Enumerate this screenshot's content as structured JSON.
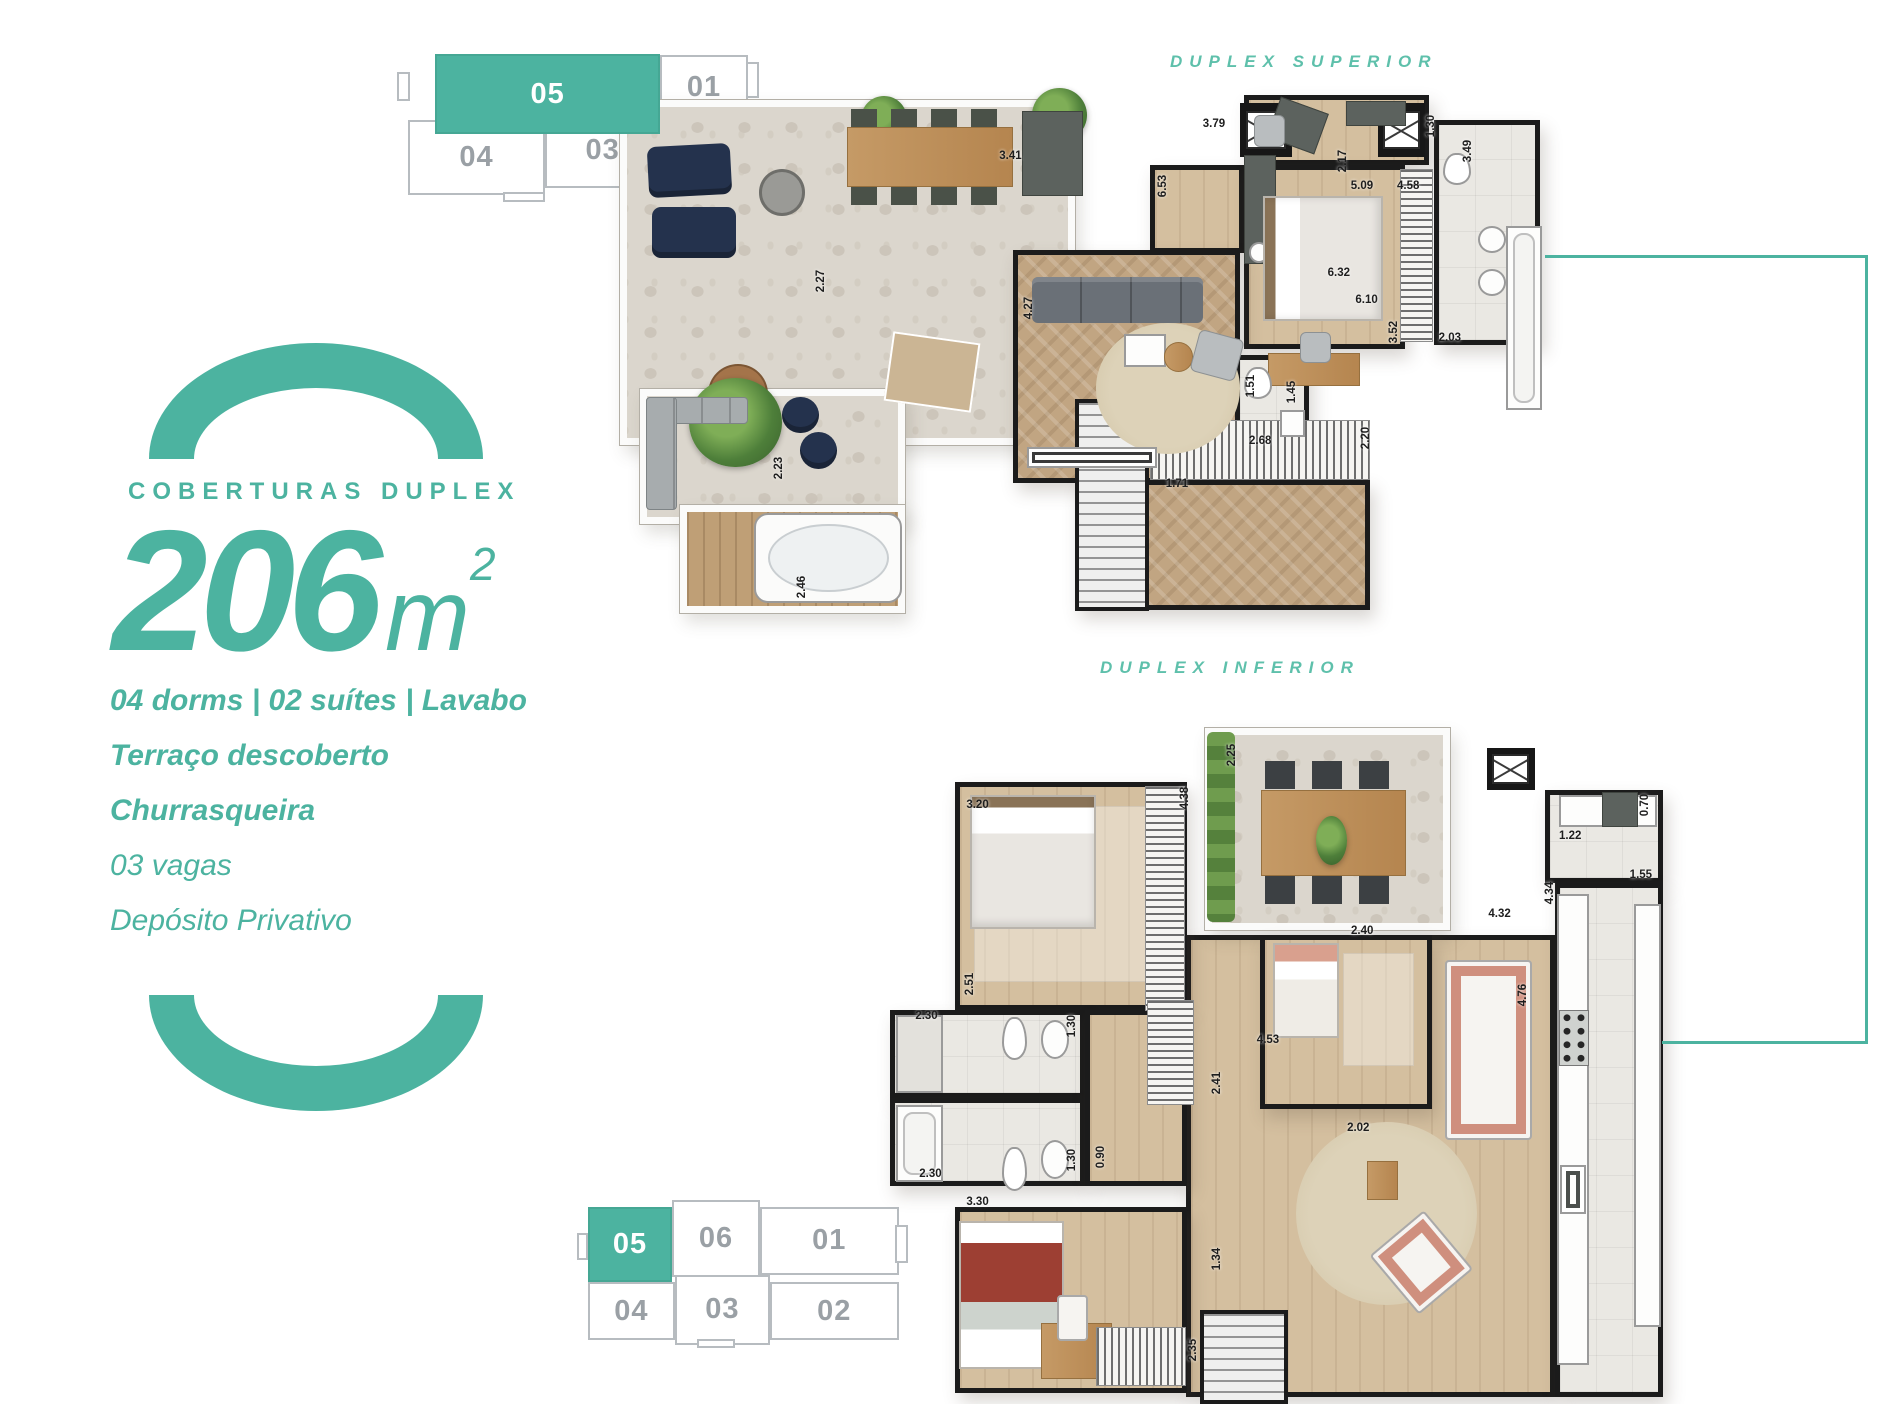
{
  "accent": {
    "teal": "#4cb3a0",
    "teal_light": "#5ec0ab",
    "keyplan_line": "#b7bcc0",
    "keyplan_text": "#9aa0a5"
  },
  "info": {
    "eyebrow": "COBERTURAS DUPLEX",
    "area_number": "206",
    "area_unit": "m",
    "area_sup": "2",
    "features": [
      {
        "label": "04 dorms | 02 suítes | Lavabo",
        "cls": "bold"
      },
      {
        "label": "Terraço descoberto",
        "cls": "bold"
      },
      {
        "label": "Churrasqueira",
        "cls": "bold"
      },
      {
        "label": "03 vagas",
        "cls": "reg"
      },
      {
        "label": "Depósito Privativo",
        "cls": "reg"
      }
    ]
  },
  "keyplans": {
    "top": {
      "highlighted_unit": "05",
      "cells": [
        {
          "label": "05",
          "cls": "hl",
          "x": 8.6,
          "y": 9,
          "w": 64.3,
          "h": 50
        },
        {
          "label": "01",
          "x": 72.9,
          "y": 9.4,
          "w": 25.1,
          "h": 40.6
        },
        {
          "label": "04",
          "x": 0.9,
          "y": 50,
          "w": 39.1,
          "h": 47
        },
        {
          "label": "03",
          "x": 40,
          "y": 45.6,
          "w": 32.9,
          "h": 47
        },
        {
          "label": "02",
          "x": 72.9,
          "y": 50,
          "w": 25.1,
          "h": 47
        },
        {
          "label": "",
          "cls": "stub",
          "x": -2.2,
          "y": 20,
          "w": 3.5,
          "h": 18
        },
        {
          "label": "",
          "cls": "stub",
          "x": 97.5,
          "y": 14,
          "w": 3.5,
          "h": 22
        },
        {
          "label": "",
          "cls": "stub",
          "x": 28,
          "y": 95,
          "w": 12,
          "h": 6
        }
      ]
    },
    "bottom": {
      "highlighted_unit": "05",
      "cells": [
        {
          "label": "05",
          "cls": "hl",
          "x": 0.9,
          "y": 8,
          "w": 26.3,
          "h": 50
        },
        {
          "label": "06",
          "x": 27.2,
          "y": 3.3,
          "w": 27.5,
          "h": 51.3
        },
        {
          "label": "01",
          "x": 54.7,
          "y": 8,
          "w": 43.3,
          "h": 45
        },
        {
          "label": "04",
          "x": 0.9,
          "y": 58,
          "w": 27.2,
          "h": 38.7
        },
        {
          "label": "03",
          "x": 28.1,
          "y": 53.3,
          "w": 29.7,
          "h": 46.7
        },
        {
          "label": "02",
          "x": 57.8,
          "y": 58,
          "w": 40.2,
          "h": 38.7
        },
        {
          "label": "",
          "cls": "stub",
          "x": -2.5,
          "y": 25,
          "w": 3.5,
          "h": 18
        },
        {
          "label": "",
          "cls": "stub",
          "x": 97,
          "y": 20,
          "w": 4,
          "h": 25
        },
        {
          "label": "",
          "cls": "stub",
          "x": 35,
          "y": 96,
          "w": 12,
          "h": 6
        }
      ]
    }
  },
  "plans": {
    "superior": {
      "title": "DUPLEX SUPERIOR",
      "dims": [
        {
          "label": "3.41",
          "x": 41,
          "y": 12
        },
        {
          "label": "3.79",
          "x": 63,
          "y": 6
        },
        {
          "label": "2.17",
          "x": 77,
          "y": 13,
          "v": true
        },
        {
          "label": "1.30",
          "x": 86.5,
          "y": 6.5,
          "v": true
        },
        {
          "label": "4.58",
          "x": 84,
          "y": 17.5
        },
        {
          "label": "5.09",
          "x": 79,
          "y": 17.5
        },
        {
          "label": "3.49",
          "x": 90.5,
          "y": 11,
          "v": true
        },
        {
          "label": "6.53",
          "x": 57.5,
          "y": 17.5,
          "v": true
        },
        {
          "label": "6.32",
          "x": 76.5,
          "y": 33.5
        },
        {
          "label": "6.10",
          "x": 79.5,
          "y": 38.5
        },
        {
          "label": "4.27",
          "x": 43,
          "y": 40,
          "v": true
        },
        {
          "label": "3.52",
          "x": 82.5,
          "y": 44.5,
          "v": true
        },
        {
          "label": "2.03",
          "x": 88.5,
          "y": 45.5
        },
        {
          "label": "1.51",
          "x": 67,
          "y": 54.5,
          "v": true
        },
        {
          "label": "1.45",
          "x": 71.5,
          "y": 55.5,
          "v": true
        },
        {
          "label": "2.68",
          "x": 68,
          "y": 64.5
        },
        {
          "label": "2.20",
          "x": 79.5,
          "y": 64,
          "v": true
        },
        {
          "label": "1.71",
          "x": 59,
          "y": 72.5
        },
        {
          "label": "2.27",
          "x": 20.5,
          "y": 35,
          "v": true
        },
        {
          "label": "2.23",
          "x": 16,
          "y": 69.5,
          "v": true
        },
        {
          "label": "2.46",
          "x": 18.5,
          "y": 91.5,
          "v": true
        }
      ]
    },
    "inferior": {
      "title": "DUPLEX INFERIOR",
      "dims": [
        {
          "label": "3.20",
          "x": 11,
          "y": 14
        },
        {
          "label": "2.51",
          "x": 10,
          "y": 39.5,
          "v": true
        },
        {
          "label": "4.38",
          "x": 37.5,
          "y": 13,
          "v": true
        },
        {
          "label": "2.25",
          "x": 43.5,
          "y": 7,
          "v": true
        },
        {
          "label": "1.22",
          "x": 86.5,
          "y": 18.5
        },
        {
          "label": "0.70",
          "x": 96,
          "y": 14,
          "v": true
        },
        {
          "label": "1.55",
          "x": 95.5,
          "y": 24
        },
        {
          "label": "4.34",
          "x": 84,
          "y": 26.5,
          "v": true
        },
        {
          "label": "4.32",
          "x": 77.5,
          "y": 29.5
        },
        {
          "label": "2.30",
          "x": 4.5,
          "y": 44
        },
        {
          "label": "1.30",
          "x": 23,
          "y": 45.5,
          "v": true
        },
        {
          "label": "2.30",
          "x": 5,
          "y": 66.5
        },
        {
          "label": "1.30",
          "x": 23,
          "y": 64.5,
          "v": true
        },
        {
          "label": "0.90",
          "x": 26.8,
          "y": 64,
          "v": true
        },
        {
          "label": "2.40",
          "x": 60,
          "y": 32
        },
        {
          "label": "2.41",
          "x": 41.5,
          "y": 53.5,
          "v": true
        },
        {
          "label": "2.02",
          "x": 59.5,
          "y": 60
        },
        {
          "label": "4.76",
          "x": 80.5,
          "y": 41,
          "v": true
        },
        {
          "label": "4.53",
          "x": 48,
          "y": 47.5
        },
        {
          "label": "1.34",
          "x": 41.5,
          "y": 78.5,
          "v": true
        },
        {
          "label": "2.35",
          "x": 38.5,
          "y": 91.5,
          "v": true
        },
        {
          "label": "3.30",
          "x": 11,
          "y": 70.5
        }
      ]
    }
  }
}
